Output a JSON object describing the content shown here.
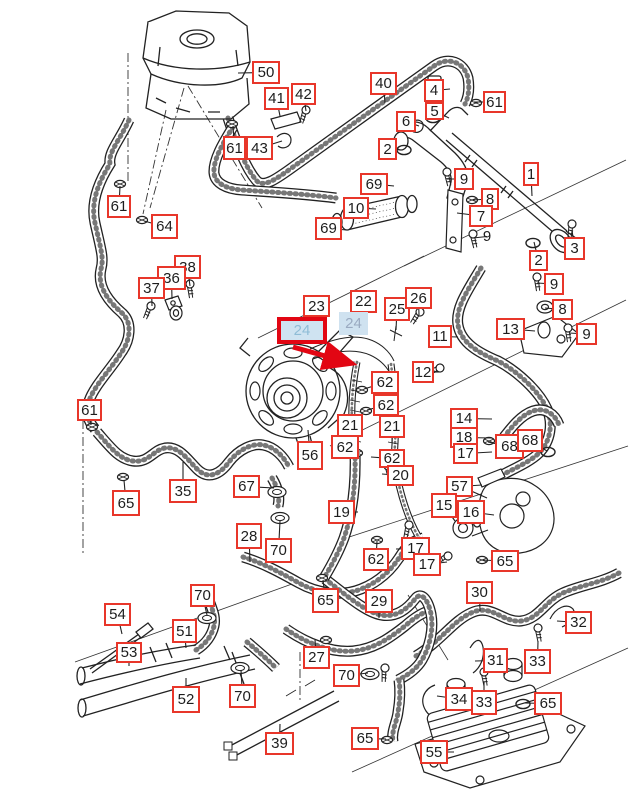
{
  "diagram": {
    "kind": "parts-catalog-exploded-diagram",
    "subject": "engine cooling hoses, expansion tank, water pump and oil cooler",
    "selected_part_number": "24",
    "colors": {
      "callout_border": "#e8362a",
      "selected_border": "#e20613",
      "selected_fill": "#cfe3f1",
      "selected_text": "#8fbcd6",
      "highlight_fill": "#cfe2f0",
      "highlight_text": "#9aaac1",
      "line_art": "#222222",
      "arrow": "#e20613"
    },
    "arrow": {
      "x1": 293,
      "y1": 347,
      "x2": 343,
      "y2": 361
    },
    "labels": [
      {
        "n": "50",
        "x": 252,
        "y": 61,
        "w": 28,
        "h": 23,
        "lx": 238,
        "ly": 73
      },
      {
        "n": "41",
        "x": 264,
        "y": 87,
        "w": 25,
        "h": 23,
        "lx": 280,
        "ly": 116
      },
      {
        "n": "42",
        "x": 291,
        "y": 83,
        "w": 25,
        "h": 22,
        "lx": 306,
        "ly": 111
      },
      {
        "n": "61",
        "x": 223,
        "y": 136,
        "w": 23,
        "h": 24,
        "lx": 233,
        "ly": 126
      },
      {
        "n": "43",
        "x": 246,
        "y": 136,
        "w": 27,
        "h": 24,
        "lx": 282,
        "ly": 141
      },
      {
        "n": "61",
        "x": 107,
        "y": 195,
        "w": 24,
        "h": 23,
        "lx": 120,
        "ly": 186
      },
      {
        "n": "64",
        "x": 151,
        "y": 214,
        "w": 27,
        "h": 25,
        "lx": 144,
        "ly": 221
      },
      {
        "n": "38",
        "x": 174,
        "y": 255,
        "w": 27,
        "h": 24,
        "lx": 190,
        "ly": 286
      },
      {
        "n": "36",
        "x": 157,
        "y": 266,
        "w": 29,
        "h": 24,
        "lx": 172,
        "ly": 299
      },
      {
        "n": "37",
        "x": 138,
        "y": 277,
        "w": 27,
        "h": 22,
        "lx": 152,
        "ly": 306
      },
      {
        "n": "61",
        "x": 77,
        "y": 399,
        "w": 25,
        "h": 22,
        "lx": 91,
        "ly": 425
      },
      {
        "n": "65",
        "x": 112,
        "y": 490,
        "w": 28,
        "h": 26,
        "lx": 124,
        "ly": 480
      },
      {
        "n": "35",
        "x": 169,
        "y": 479,
        "w": 28,
        "h": 24,
        "lx": 183,
        "ly": 462
      },
      {
        "n": "67",
        "x": 233,
        "y": 475,
        "w": 27,
        "h": 23,
        "lx": 274,
        "ly": 488
      },
      {
        "n": "56",
        "x": 297,
        "y": 441,
        "w": 26,
        "h": 29,
        "lx": 308,
        "ly": 430
      },
      {
        "n": "40",
        "x": 370,
        "y": 72,
        "w": 27,
        "h": 23,
        "lx": 385,
        "ly": 103
      },
      {
        "n": "4",
        "x": 424,
        "y": 79,
        "w": 20,
        "h": 23,
        "lx": 450,
        "ly": 89
      },
      {
        "n": "5",
        "x": 425,
        "y": 102,
        "w": 19,
        "h": 18,
        "lx": 449,
        "ly": 118
      },
      {
        "n": "61",
        "x": 483,
        "y": 91,
        "w": 23,
        "h": 22,
        "lx": 474,
        "ly": 102
      },
      {
        "n": "6",
        "x": 396,
        "y": 111,
        "w": 20,
        "h": 21,
        "lx": 419,
        "ly": 126
      },
      {
        "n": "2",
        "x": 378,
        "y": 138,
        "w": 19,
        "h": 22,
        "lx": 401,
        "ly": 150
      },
      {
        "n": "1",
        "x": 523,
        "y": 162,
        "w": 16,
        "h": 24,
        "lx": 532,
        "ly": 196
      },
      {
        "n": "69",
        "x": 360,
        "y": 173,
        "w": 28,
        "h": 22,
        "lx": 394,
        "ly": 186
      },
      {
        "n": "10",
        "x": 343,
        "y": 197,
        "w": 26,
        "h": 22,
        "lx": 376,
        "ly": 209
      },
      {
        "n": "69",
        "x": 315,
        "y": 217,
        "w": 27,
        "h": 23,
        "lx": 347,
        "ly": 230
      },
      {
        "n": "9",
        "x": 454,
        "y": 168,
        "w": 20,
        "h": 22,
        "lx": 447,
        "ly": 179
      },
      {
        "n": "8",
        "x": 481,
        "y": 188,
        "w": 18,
        "h": 22,
        "lx": 472,
        "ly": 200
      },
      {
        "n": "7",
        "x": 469,
        "y": 205,
        "w": 24,
        "h": 22,
        "lx": 457,
        "ly": 213
      },
      {
        "n": "9",
        "x": 480,
        "y": 228,
        "w": 14,
        "h": 17,
        "lx": 473,
        "ly": 238,
        "style": "plain"
      },
      {
        "n": "2",
        "x": 529,
        "y": 250,
        "w": 19,
        "h": 21,
        "lx": 534,
        "ly": 242
      },
      {
        "n": "3",
        "x": 564,
        "y": 237,
        "w": 21,
        "h": 23,
        "lx": 572,
        "ly": 230
      },
      {
        "n": "9",
        "x": 544,
        "y": 273,
        "w": 20,
        "h": 22,
        "lx": 537,
        "ly": 283
      },
      {
        "n": "8",
        "x": 552,
        "y": 299,
        "w": 21,
        "h": 21,
        "lx": 545,
        "ly": 308
      },
      {
        "n": "9",
        "x": 576,
        "y": 323,
        "w": 21,
        "h": 22,
        "lx": 569,
        "ly": 333
      },
      {
        "n": "13",
        "x": 496,
        "y": 318,
        "w": 29,
        "h": 22,
        "lx": 535,
        "ly": 331
      },
      {
        "n": "23",
        "x": 303,
        "y": 295,
        "w": 27,
        "h": 22,
        "lx": 311,
        "ly": 329
      },
      {
        "n": "22",
        "x": 350,
        "y": 290,
        "w": 27,
        "h": 23,
        "lx": 360,
        "ly": 318
      },
      {
        "n": "25",
        "x": 384,
        "y": 297,
        "w": 26,
        "h": 24,
        "lx": 396,
        "ly": 330
      },
      {
        "n": "26",
        "x": 405,
        "y": 287,
        "w": 27,
        "h": 22,
        "lx": 419,
        "ly": 315
      },
      {
        "n": "24",
        "x": 277,
        "y": 317,
        "w": 50,
        "h": 27,
        "style": "selected"
      },
      {
        "n": "24",
        "x": 339,
        "y": 312,
        "w": 29,
        "h": 23,
        "style": "highlight"
      },
      {
        "n": "11",
        "x": 428,
        "y": 325,
        "w": 24,
        "h": 23,
        "lx": 458,
        "ly": 337
      },
      {
        "n": "12",
        "x": 412,
        "y": 361,
        "w": 22,
        "h": 22,
        "lx": 439,
        "ly": 372
      },
      {
        "n": "62",
        "x": 371,
        "y": 371,
        "w": 28,
        "h": 23,
        "lx": 364,
        "ly": 389
      },
      {
        "n": "62",
        "x": 373,
        "y": 394,
        "w": 26,
        "h": 22,
        "lx": 367,
        "ly": 410
      },
      {
        "n": "21",
        "x": 337,
        "y": 414,
        "w": 26,
        "h": 23,
        "lx": 352,
        "ly": 440
      },
      {
        "n": "21",
        "x": 379,
        "y": 415,
        "w": 26,
        "h": 23,
        "lx": 392,
        "ly": 443
      },
      {
        "n": "62",
        "x": 331,
        "y": 435,
        "w": 28,
        "h": 24,
        "lx": 357,
        "ly": 452
      },
      {
        "n": "62",
        "x": 379,
        "y": 449,
        "w": 26,
        "h": 19,
        "lx": 371,
        "ly": 457
      },
      {
        "n": "20",
        "x": 387,
        "y": 465,
        "w": 27,
        "h": 21,
        "lx": 382,
        "ly": 474
      },
      {
        "n": "14",
        "x": 450,
        "y": 408,
        "w": 28,
        "h": 21,
        "lx": 492,
        "ly": 419
      },
      {
        "n": "18",
        "x": 450,
        "y": 427,
        "w": 28,
        "h": 21,
        "lx": 492,
        "ly": 438
      },
      {
        "n": "17",
        "x": 453,
        "y": 443,
        "w": 25,
        "h": 21,
        "lx": 492,
        "ly": 452
      },
      {
        "n": "68",
        "x": 495,
        "y": 434,
        "w": 29,
        "h": 25,
        "lx": 488,
        "ly": 442
      },
      {
        "n": "68",
        "x": 517,
        "y": 429,
        "w": 26,
        "h": 23,
        "lx": 547,
        "ly": 451
      },
      {
        "n": "57",
        "x": 446,
        "y": 476,
        "w": 27,
        "h": 21,
        "lx": 482,
        "ly": 485
      },
      {
        "n": "19",
        "x": 328,
        "y": 500,
        "w": 27,
        "h": 24,
        "lx": 358,
        "ly": 512
      },
      {
        "n": "15",
        "x": 431,
        "y": 493,
        "w": 26,
        "h": 25,
        "lx": 455,
        "ly": 521
      },
      {
        "n": "16",
        "x": 457,
        "y": 500,
        "w": 28,
        "h": 24,
        "lx": 494,
        "ly": 515
      },
      {
        "n": "62",
        "x": 363,
        "y": 548,
        "w": 26,
        "h": 23,
        "lx": 377,
        "ly": 541
      },
      {
        "n": "17",
        "x": 401,
        "y": 537,
        "w": 29,
        "h": 23,
        "lx": 396,
        "ly": 549
      },
      {
        "n": "17",
        "x": 413,
        "y": 553,
        "w": 28,
        "h": 23,
        "lx": 447,
        "ly": 562
      },
      {
        "n": "65",
        "x": 491,
        "y": 550,
        "w": 28,
        "h": 22,
        "lx": 481,
        "ly": 560
      },
      {
        "n": "28",
        "x": 236,
        "y": 523,
        "w": 26,
        "h": 26,
        "lx": 250,
        "ly": 562
      },
      {
        "n": "70",
        "x": 265,
        "y": 538,
        "w": 27,
        "h": 25,
        "lx": 280,
        "ly": 521
      },
      {
        "n": "70",
        "x": 190,
        "y": 584,
        "w": 25,
        "h": 23,
        "lx": 207,
        "ly": 615
      },
      {
        "n": "65",
        "x": 312,
        "y": 588,
        "w": 27,
        "h": 25,
        "lx": 323,
        "ly": 580
      },
      {
        "n": "29",
        "x": 365,
        "y": 589,
        "w": 28,
        "h": 24,
        "lx": 379,
        "ly": 618
      },
      {
        "n": "30",
        "x": 466,
        "y": 581,
        "w": 27,
        "h": 23,
        "lx": 480,
        "ly": 611
      },
      {
        "n": "32",
        "x": 565,
        "y": 611,
        "w": 27,
        "h": 23,
        "lx": 557,
        "ly": 621
      },
      {
        "n": "54",
        "x": 104,
        "y": 603,
        "w": 27,
        "h": 23,
        "lx": 122,
        "ly": 634
      },
      {
        "n": "51",
        "x": 172,
        "y": 619,
        "w": 25,
        "h": 24,
        "lx": 186,
        "ly": 648
      },
      {
        "n": "53",
        "x": 116,
        "y": 642,
        "w": 26,
        "h": 21,
        "lx": 129,
        "ly": 666
      },
      {
        "n": "27",
        "x": 303,
        "y": 646,
        "w": 27,
        "h": 23,
        "lx": 315,
        "ly": 640
      },
      {
        "n": "31",
        "x": 483,
        "y": 648,
        "w": 25,
        "h": 25,
        "lx": 475,
        "ly": 661
      },
      {
        "n": "33",
        "x": 524,
        "y": 649,
        "w": 27,
        "h": 25,
        "lx": 538,
        "ly": 641
      },
      {
        "n": "70",
        "x": 333,
        "y": 664,
        "w": 27,
        "h": 23,
        "lx": 368,
        "ly": 673
      },
      {
        "n": "52",
        "x": 172,
        "y": 686,
        "w": 28,
        "h": 27,
        "lx": 186,
        "ly": 678
      },
      {
        "n": "70",
        "x": 229,
        "y": 684,
        "w": 27,
        "h": 24,
        "lx": 241,
        "ly": 670
      },
      {
        "n": "34",
        "x": 445,
        "y": 687,
        "w": 28,
        "h": 24,
        "lx": 437,
        "ly": 696
      },
      {
        "n": "33",
        "x": 471,
        "y": 690,
        "w": 26,
        "h": 25,
        "lx": 484,
        "ly": 682
      },
      {
        "n": "65",
        "x": 534,
        "y": 692,
        "w": 28,
        "h": 23,
        "lx": 524,
        "ly": 703
      },
      {
        "n": "65",
        "x": 351,
        "y": 727,
        "w": 28,
        "h": 23,
        "lx": 386,
        "ly": 739
      },
      {
        "n": "39",
        "x": 265,
        "y": 732,
        "w": 29,
        "h": 23,
        "lx": 280,
        "ly": 724
      },
      {
        "n": "55",
        "x": 420,
        "y": 740,
        "w": 28,
        "h": 24,
        "lx": 454,
        "ly": 752
      }
    ]
  }
}
